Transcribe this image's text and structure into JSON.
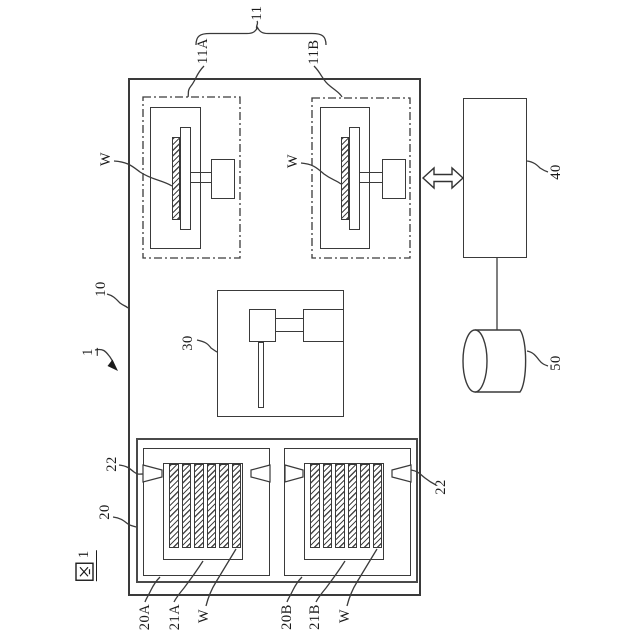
{
  "figure_label": {
    "full": "図1",
    "kanji": "図",
    "number": "1"
  },
  "labels": {
    "apparatus": "1",
    "housing": "10",
    "process_group": "11",
    "process_unit_a": "11A",
    "process_unit_b": "11B",
    "loader": "20",
    "carrier_a": "20A",
    "carrier_b": "20B",
    "rack_a": "21A",
    "rack_b": "21B",
    "detector": "22",
    "transfer_unit": "30",
    "controller": "40",
    "storage": "50",
    "wafer": "W"
  }
}
